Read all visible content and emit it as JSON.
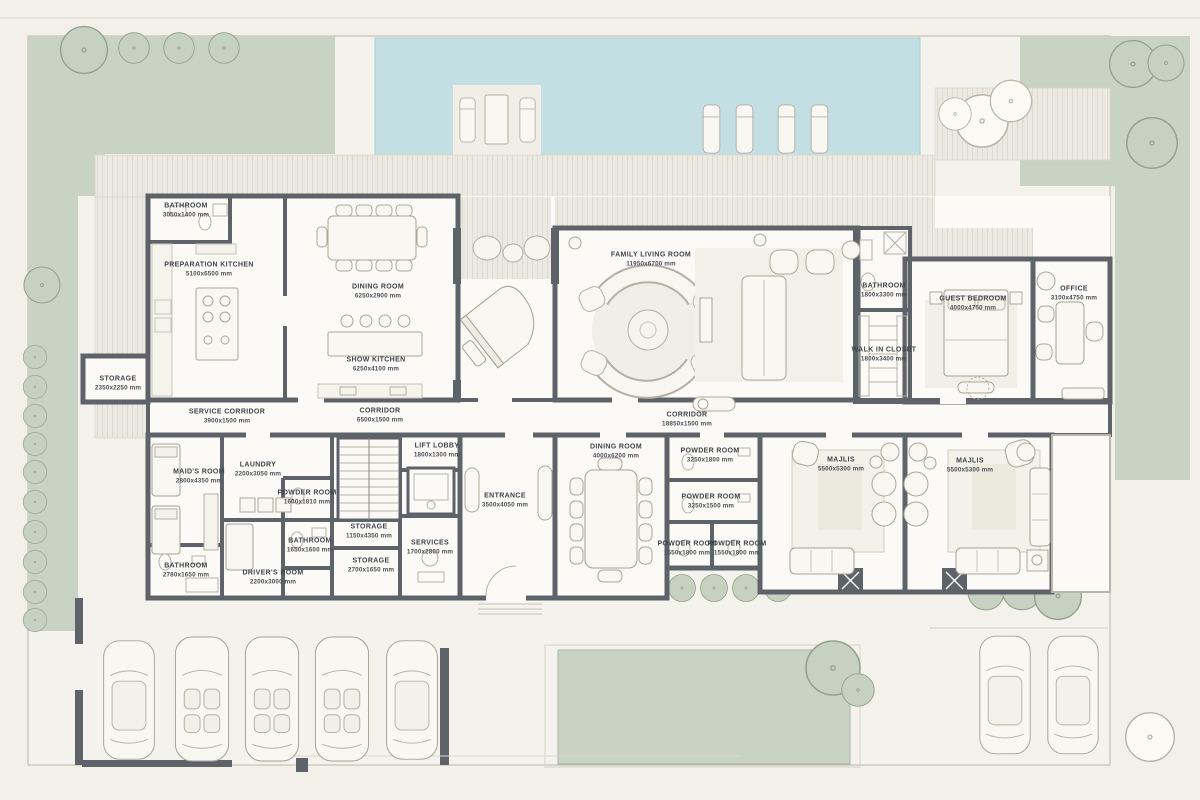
{
  "title": "villa-ground-floor-plan",
  "palette": {
    "background": "#f2f0e9",
    "wall": "#5d6369",
    "floor": "#fbfaf6",
    "deck": "#ebe9e1",
    "pool": "#c4dfe3",
    "garden_green": "#c9d3c4",
    "tree_outline": "#93a38d",
    "furniture_line": "#aba797",
    "label_text": "#3f444b"
  },
  "rooms": [
    {
      "id": "bathroom-kitchen",
      "name": "BATHROOM",
      "dims": "3050x1400 mm"
    },
    {
      "id": "preparation-kitchen",
      "name": "PREPARATION KITCHEN",
      "dims": "5100x6500 mm"
    },
    {
      "id": "dining-room-top",
      "name": "DINING ROOM",
      "dims": "6250x2900 mm"
    },
    {
      "id": "show-kitchen",
      "name": "SHOW KITCHEN",
      "dims": "6250x4100 mm"
    },
    {
      "id": "family-living-room",
      "name": "FAMILY LIVING ROOM",
      "dims": "11950x6700 mm"
    },
    {
      "id": "bathroom-guest",
      "name": "BATHROOM",
      "dims": "1800x3300 mm"
    },
    {
      "id": "walk-in-closet",
      "name": "WALK IN CLOSET",
      "dims": "1800x3400 mm"
    },
    {
      "id": "guest-bedroom",
      "name": "GUEST BEDROOM",
      "dims": "4000x4750 mm"
    },
    {
      "id": "office",
      "name": "OFFICE",
      "dims": "3100x4750 mm"
    },
    {
      "id": "storage-garden",
      "name": "STORAGE",
      "dims": "2350x2250 mm"
    },
    {
      "id": "service-corridor",
      "name": "SERVICE CORRIDOR",
      "dims": "3900x1500 mm"
    },
    {
      "id": "corridor-west",
      "name": "CORRIDOR",
      "dims": "6500x1500 mm"
    },
    {
      "id": "corridor-main",
      "name": "CORRIDOR",
      "dims": "18850x1500 mm"
    },
    {
      "id": "lift-lobby",
      "name": "LIFT LOBBY",
      "dims": "1800x1300 mm"
    },
    {
      "id": "maids-room",
      "name": "MAID'S ROOM",
      "dims": "2800x4350 mm"
    },
    {
      "id": "laundry",
      "name": "LAUNDRY",
      "dims": "2200x3050 mm"
    },
    {
      "id": "powder-room-service",
      "name": "POWDER ROOM",
      "dims": "1600x1810 mm"
    },
    {
      "id": "bathroom-service",
      "name": "BATHROOM",
      "dims": "1650x1600 mm"
    },
    {
      "id": "bathroom-maids",
      "name": "BATHROOM",
      "dims": "2780x1650 mm"
    },
    {
      "id": "drivers-room",
      "name": "DRIVER'S ROOM",
      "dims": "2200x3000 mm"
    },
    {
      "id": "storage-stairs",
      "name": "STORAGE",
      "dims": "1150x4350 mm"
    },
    {
      "id": "storage-low",
      "name": "STORAGE",
      "dims": "2700x1650 mm"
    },
    {
      "id": "services",
      "name": "SERVICES",
      "dims": "1700x2800 mm"
    },
    {
      "id": "entrance",
      "name": "ENTRANCE",
      "dims": "3500x4050 mm"
    },
    {
      "id": "dining-room-formal",
      "name": "DINING ROOM",
      "dims": "4000x6200 mm"
    },
    {
      "id": "powder-room-1",
      "name": "POWDER ROOM",
      "dims": "3250x1800 mm"
    },
    {
      "id": "powder-room-2",
      "name": "POWDER ROOM",
      "dims": "3250x1500 mm"
    },
    {
      "id": "powder-room-3",
      "name": "POWDER ROOM",
      "dims": "1550x1800 mm"
    },
    {
      "id": "powder-room-4",
      "name": "POWDER ROOM",
      "dims": "1550x1800 mm"
    },
    {
      "id": "majlis-west",
      "name": "MAJLIS",
      "dims": "5500x5300 mm"
    },
    {
      "id": "majlis-east",
      "name": "MAJLIS",
      "dims": "5500x5300 mm"
    }
  ]
}
